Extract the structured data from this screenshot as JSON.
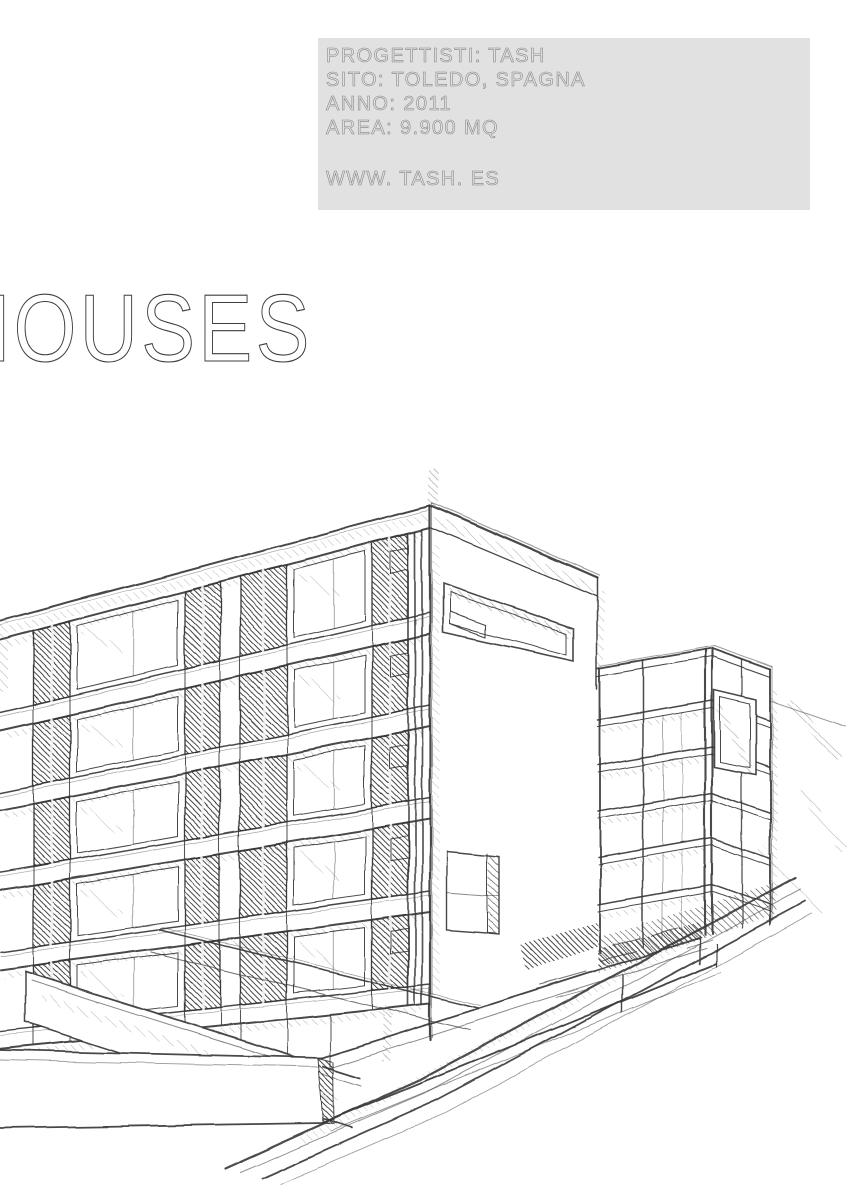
{
  "page": {
    "background": "#ffffff"
  },
  "info_panel": {
    "background": "#e1e1e1",
    "text_color": "#868686",
    "lines": {
      "designers": "PROGETTISTI: TASH",
      "site": "SITO: TOLEDO, SPAGNA",
      "year": "ANNO: 2011",
      "area": "AREA: 9.900 MQ",
      "website": "WWW. TASH. ES"
    }
  },
  "title": {
    "text": "HOUSES",
    "color": "#3d3d3d"
  },
  "illustration": {
    "alt": "Hand-drawn pencil sketch in two-point perspective of two modern flat-roofed apartment blocks with banded facades, recessed window strips, low site walls and a street sloping down to the left"
  },
  "sketch_colors": {
    "line": "#383838",
    "hatch_dark": "#262626",
    "hatch_mid": "#4a4a4a",
    "hatch_light": "#6a6a6a"
  }
}
